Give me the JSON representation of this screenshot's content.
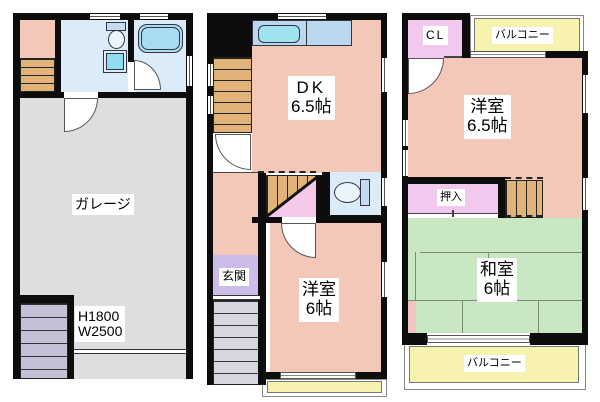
{
  "floor1": {
    "garage": {
      "label": "ガレージ",
      "note1": "H1800",
      "note2": "W2500"
    }
  },
  "floor2": {
    "dk": {
      "label": "DK",
      "size": "6.5帖"
    },
    "genkan": {
      "label": "玄関"
    },
    "yoshitsu": {
      "label": "洋室",
      "size": "6帖"
    }
  },
  "floor3": {
    "cl": {
      "label": "CL"
    },
    "balcony_top": {
      "label": "バルコニー"
    },
    "yoshitsu": {
      "label": "洋室",
      "size": "6.5帖"
    },
    "oshiire": {
      "label": "押入"
    },
    "washitsu": {
      "label": "和室",
      "size": "6帖"
    },
    "balcony_bottom": {
      "label": "バルコニー"
    }
  },
  "colors": {
    "wall": "#0d0d0d",
    "floor_salmon": "#f4c8b9",
    "wet_area_blue": "#dcebf8",
    "fixture_blue": "#a9dcf2",
    "counter_blue": "#b9d7ee",
    "garage_gray": "#dedede",
    "tatami_green": "#c9e7c2",
    "closet_pink": "#f3c8ef",
    "genkan_purple": "#cbbce9",
    "balcony_yellow": "#f7f3ae",
    "stairs_tan": "#e2b379",
    "stairs_lavender": "#c6c0d6",
    "steps_gray": "#d8d6e0"
  }
}
